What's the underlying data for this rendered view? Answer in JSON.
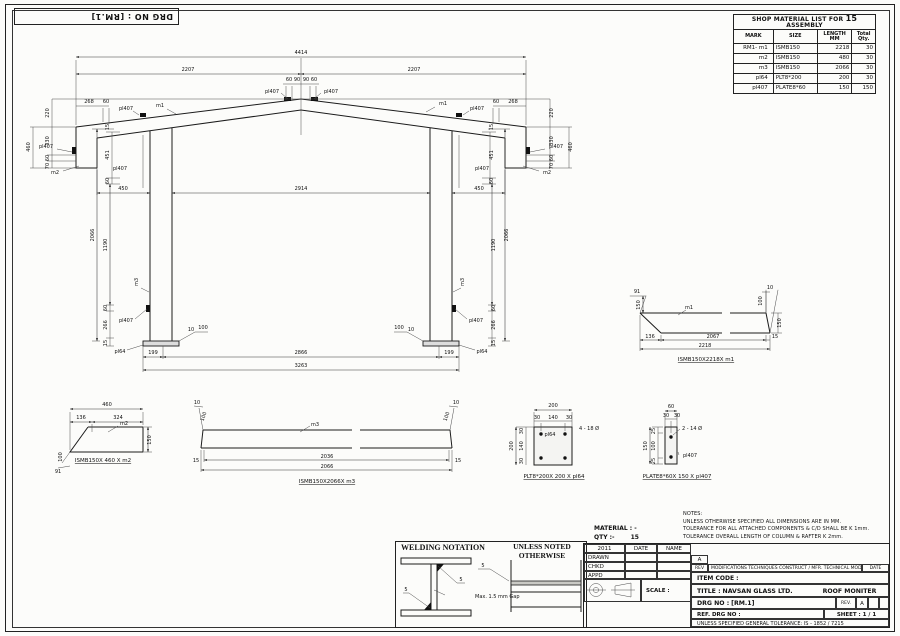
{
  "sheet": {
    "drg_no": "DRG NO :  [RM.1]"
  },
  "material_list": {
    "title_prefix": "SHOP MATERIAL LIST FOR",
    "title_qty": "15",
    "title_suffix": "ASSEMBLY",
    "col_mark": "MARK",
    "col_size": "SIZE",
    "col_length1": "LENGTH",
    "col_length2": "MM",
    "col_qty1": "Total",
    "col_qty2": "Qty.",
    "rows": [
      {
        "mark": "RM1- m1",
        "size": "ISMB150",
        "length": "2218",
        "qty": "30"
      },
      {
        "mark": "m2",
        "size": "ISMB150",
        "length": "480",
        "qty": "30"
      },
      {
        "mark": "m3",
        "size": "ISMB150",
        "length": "2066",
        "qty": "30"
      },
      {
        "mark": "pl64",
        "size": "PLT8*200",
        "length": "200",
        "qty": "30"
      },
      {
        "mark": "pl407",
        "size": "PLATE8*60",
        "length": "150",
        "qty": "150"
      }
    ]
  },
  "elev": {
    "total": "4414",
    "half": "2207",
    "d60": "60",
    "d90": "90",
    "d268": "268",
    "pl407": "pl407",
    "m1": "m1",
    "m2": "m2",
    "m3": "m3",
    "pl64": "pl64",
    "v220": "220",
    "v330": "330",
    "v460": "460",
    "v70": "70",
    "d15": "15",
    "d451": "451",
    "d450": "450",
    "c2066": "2066",
    "c1190": "1190",
    "c266": "266",
    "d10": "10",
    "d100": "100",
    "mid": "2914",
    "g199": "199",
    "g2866": "2866",
    "g3263": "3263"
  },
  "m1d": {
    "label": "m1",
    "a91": "91",
    "l150": "150",
    "t10": "10",
    "r100": "100",
    "r150": "150",
    "b136": "136",
    "b2067": "2067",
    "b15": "15",
    "total": "2218",
    "caption": "ISMB150X2218X m1"
  },
  "m2d": {
    "label": "m2",
    "total": "460",
    "b136": "136",
    "b324": "324",
    "r150": "150",
    "l100": "100",
    "a91": "91",
    "caption": "ISMB150X 460 X m2"
  },
  "m3d": {
    "label": "m3",
    "c10": "10",
    "c100": "100",
    "e15": "15",
    "inner": "2036",
    "total": "2066",
    "caption": "ISMB150X2066X m3"
  },
  "pl64d": {
    "label": "pl64",
    "w200": "200",
    "s30": "30",
    "s140": "140",
    "holes": "4 - 18 Ø",
    "caption": "PLT8*200X 200 X pl64"
  },
  "pl407d": {
    "label": "pl407",
    "w60": "60",
    "s30": "30",
    "h150": "150",
    "s25": "25",
    "s100": "100",
    "holes": "2 - 14 Ø",
    "caption": "PLATE8*60X 150 X pl407"
  },
  "welding": {
    "title": "WELDING NOTATION",
    "unless1": "UNLESS NOTED",
    "unless2": "OTHERWISE",
    "w5": "5",
    "gap": "Max. 1.5 mm Gap"
  },
  "title_block": {
    "material": "MATERIAL : -",
    "qty_label": "QTY :-",
    "qty": "15",
    "notes_title": "NOTES:",
    "note1": "UNLESS  OTHERWISE  SPECIFIED ALL DIMENSIONS ARE IN MM.",
    "note2": "TOLERANCE FOR ALL ATTACHED COMPONENTS & C/D  SHALL BE K 1mm.",
    "note3": "TOLERANCE OVERALL LENGTH OF COLUMN & RAFTER K 2mm.",
    "year": "2011",
    "date": "DATE",
    "name": "NAME",
    "drawn": "DRAWN",
    "chkd": "CHKD",
    "appd": "APPD",
    "rev_a": "A",
    "rev": "REV",
    "mods": "MODIFICATIONS TECHNIQUES CONSTRUCT / MFR. TECHNICAL MODIFICATIONS",
    "mods_date": "DATE",
    "scale": "SCALE :",
    "item_code": "ITEM  CODE :",
    "title_label": "TITLE :",
    "company": "NAVSAN GLASS LTD.",
    "proj_title": "ROOF MONITER",
    "drg_label": "DRG NO :",
    "drg_no": "[RM.1]",
    "rev_col": "REV.",
    "rev_val": "A",
    "ref_label": "REF. DRG NO :",
    "sheet": "SHEET : 1 / 1",
    "tolerance": "UNLESS SPECIFIED GENERAL TOLERANCE: IS - 1852 / 7215"
  }
}
